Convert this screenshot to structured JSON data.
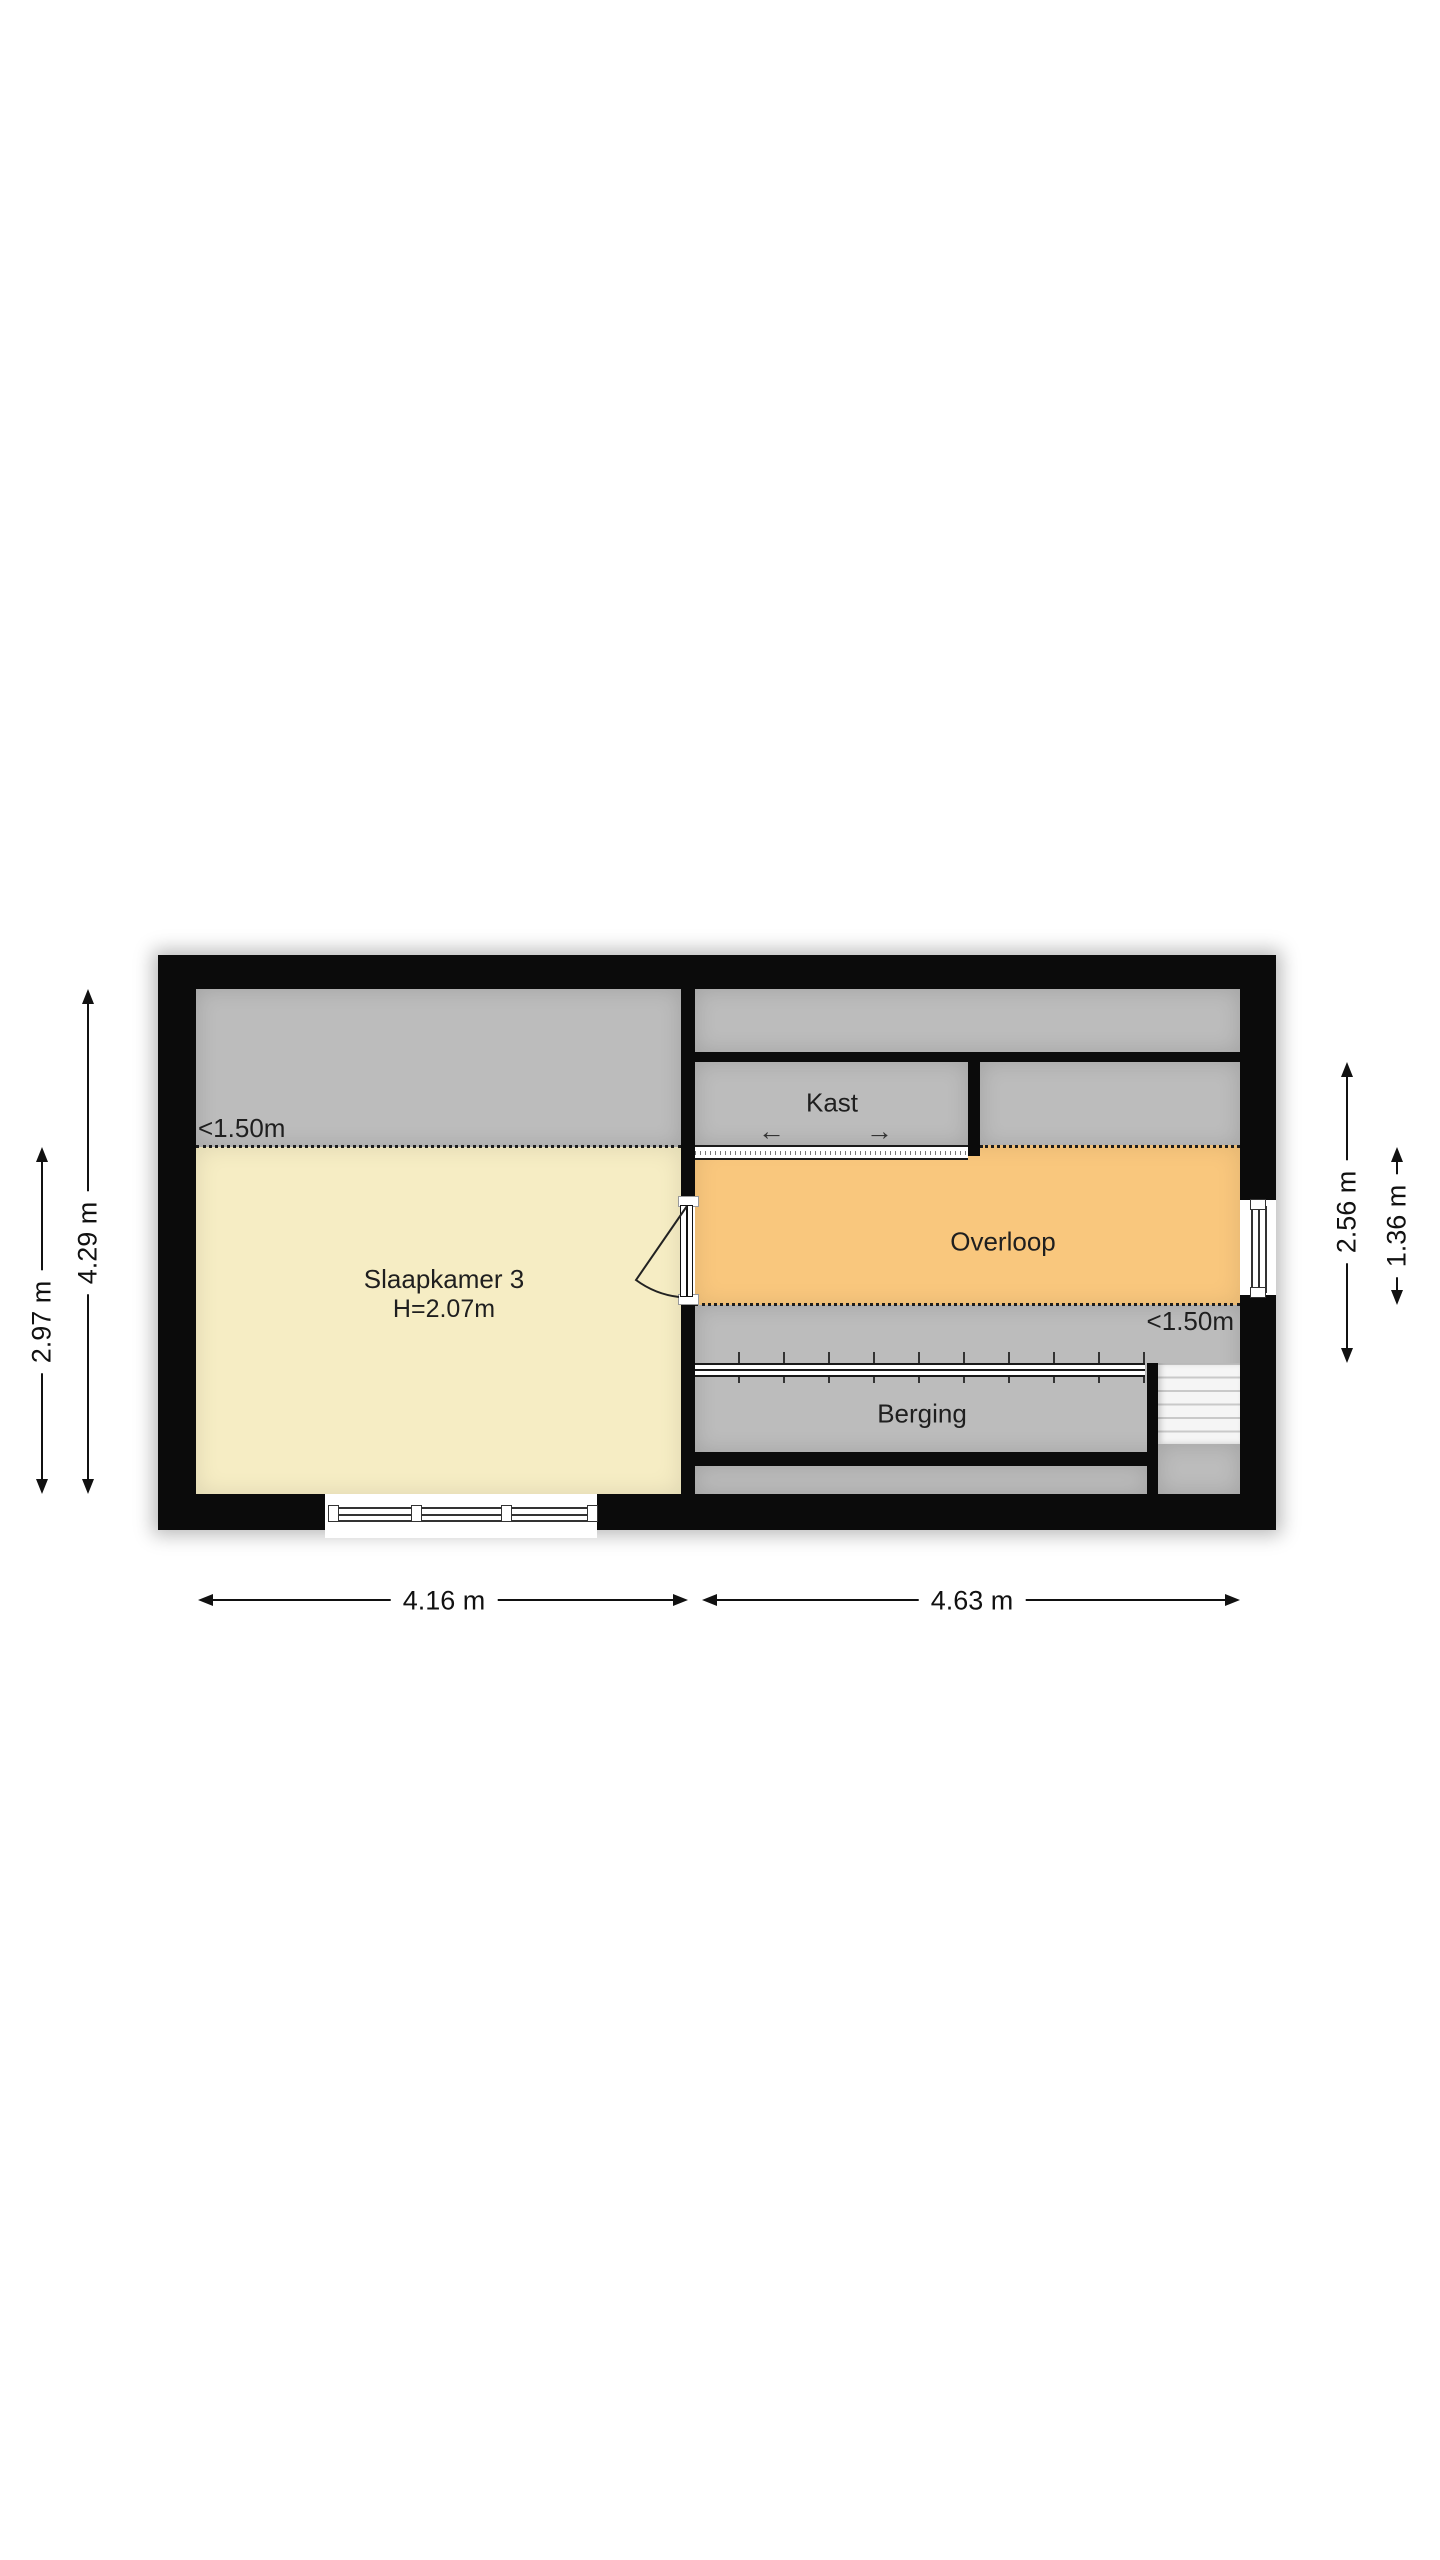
{
  "floorplan": {
    "rooms": {
      "slaapkamer": {
        "label": "Slaapkamer 3",
        "height": "H=2.07m",
        "color": "#f6edc4"
      },
      "kast": {
        "label": "Kast",
        "color": "#bcbcbc"
      },
      "overloop": {
        "label": "Overloop",
        "color": "#f9c77d"
      },
      "berging": {
        "label": "Berging",
        "color": "#bcbcbc"
      }
    },
    "low_ceiling": {
      "left": "<1.50m",
      "right": "<1.50m"
    },
    "kast_slide_arrows": {
      "left": "←",
      "right": "→"
    },
    "dimensions": {
      "left_total": "4.29 m",
      "left_bedroom": "2.97 m",
      "right_section": "2.56 m",
      "right_overloop": "1.36 m",
      "bottom_left": "4.16 m",
      "bottom_right": "4.63 m"
    },
    "colors": {
      "wall": "#0b0b0b",
      "low_zone": "#bcbcbc",
      "bedroom": "#f6edc4",
      "hall": "#f9c77d",
      "background": "#ffffff"
    }
  }
}
